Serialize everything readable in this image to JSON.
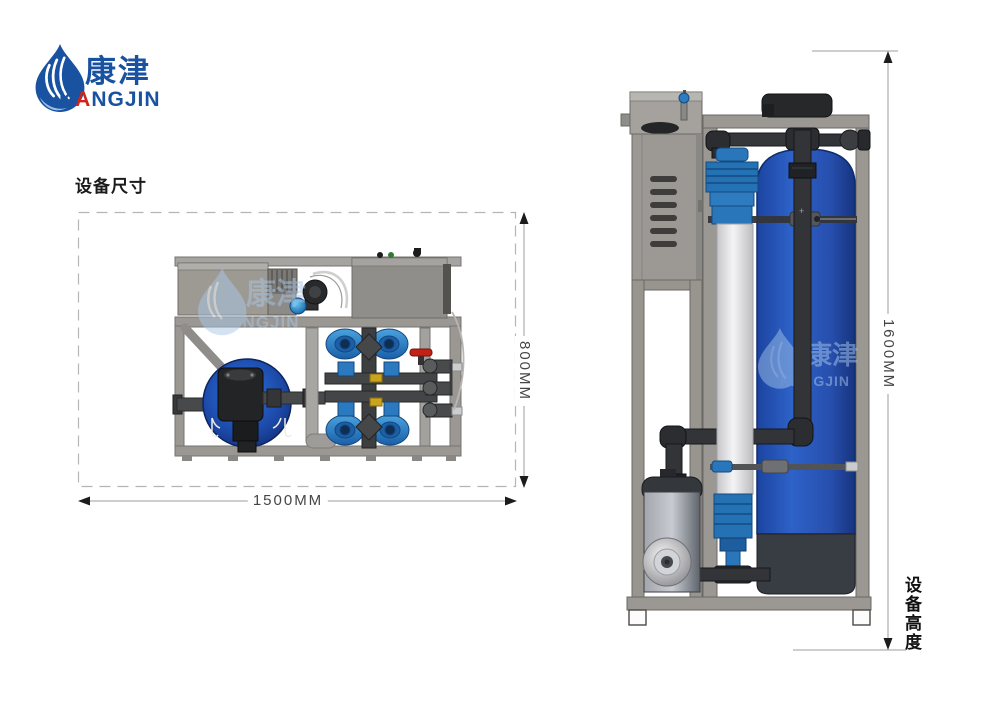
{
  "page": {
    "width": 1000,
    "height": 709,
    "background": "#ffffff"
  },
  "logo": {
    "brand_cn": "康津",
    "brand_en": "KANGJIN",
    "brand_en_parts": {
      "p1": "K",
      "p2": "A",
      "p3": "NGJIN"
    },
    "brand_blue": "#1852a0",
    "accent_red": "#d02418"
  },
  "dimension_diagram": {
    "heading": "设备尺寸",
    "top_view": {
      "width_label": "1500MM",
      "depth_label": "800MM"
    },
    "side_view": {
      "height_label": "1600MM",
      "caption": "设备高度"
    }
  },
  "colors": {
    "dimension_line": "#9d9d9d",
    "dimension_arrow": "#1c1c1c",
    "dashed_box": "#b5b5b5",
    "frame_gray": "#9b9894",
    "cabinet_gray": "#9c9995",
    "pipe_black": "#323438",
    "tank_blue": "#2256b4",
    "filter_blue": "#2e86c8",
    "valve_red": "#c32016",
    "brass_yellow": "#c9a41c",
    "watermark_blue": "#aac6e6"
  }
}
